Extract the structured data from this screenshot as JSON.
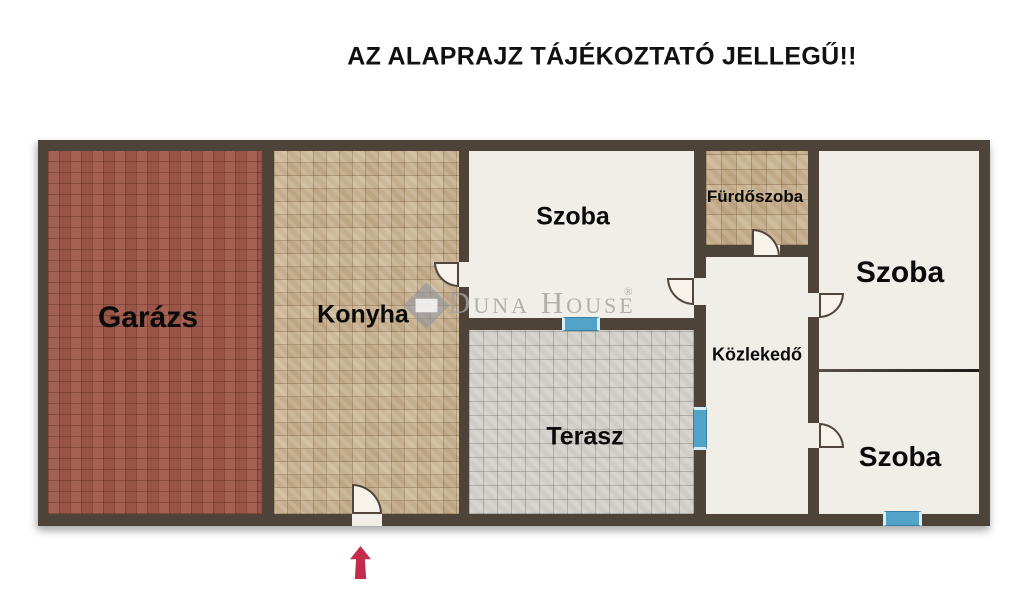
{
  "title": "AZ ALAPRAJZ TÁJÉKOZTATÓ JELLEGŰ!!",
  "rooms": {
    "garazs": {
      "label": "Garázs"
    },
    "konyha": {
      "label": "Konyha"
    },
    "szoba_top": {
      "label": "Szoba"
    },
    "furdoszoba": {
      "label": "Fürdőszoba"
    },
    "szoba_right_top": {
      "label": "Szoba"
    },
    "kozlekedo": {
      "label": "Közlekedő"
    },
    "terasz": {
      "label": "Terasz"
    },
    "szoba_right_bottom": {
      "label": "Szoba"
    }
  },
  "watermark": {
    "brand": "Duna House",
    "registered": "®"
  },
  "icons": {
    "entrance_arrow": "up-arrow",
    "door_swing": "quarter-circle-door",
    "window_marker": "blue-window"
  },
  "colors": {
    "wall": "#4d4339",
    "garage_floor": "#a0594b",
    "kitchen_floor": "#cdb999",
    "bathroom_floor": "#c9b492",
    "terrace_floor": "#d5d2cc",
    "room_floor": "#f1eee8",
    "window_marker": "#53a2c8",
    "entrance_arrow": "#c22d4e",
    "watermark_gray": "#a2a09d",
    "label_text": "#0b0b0b"
  }
}
